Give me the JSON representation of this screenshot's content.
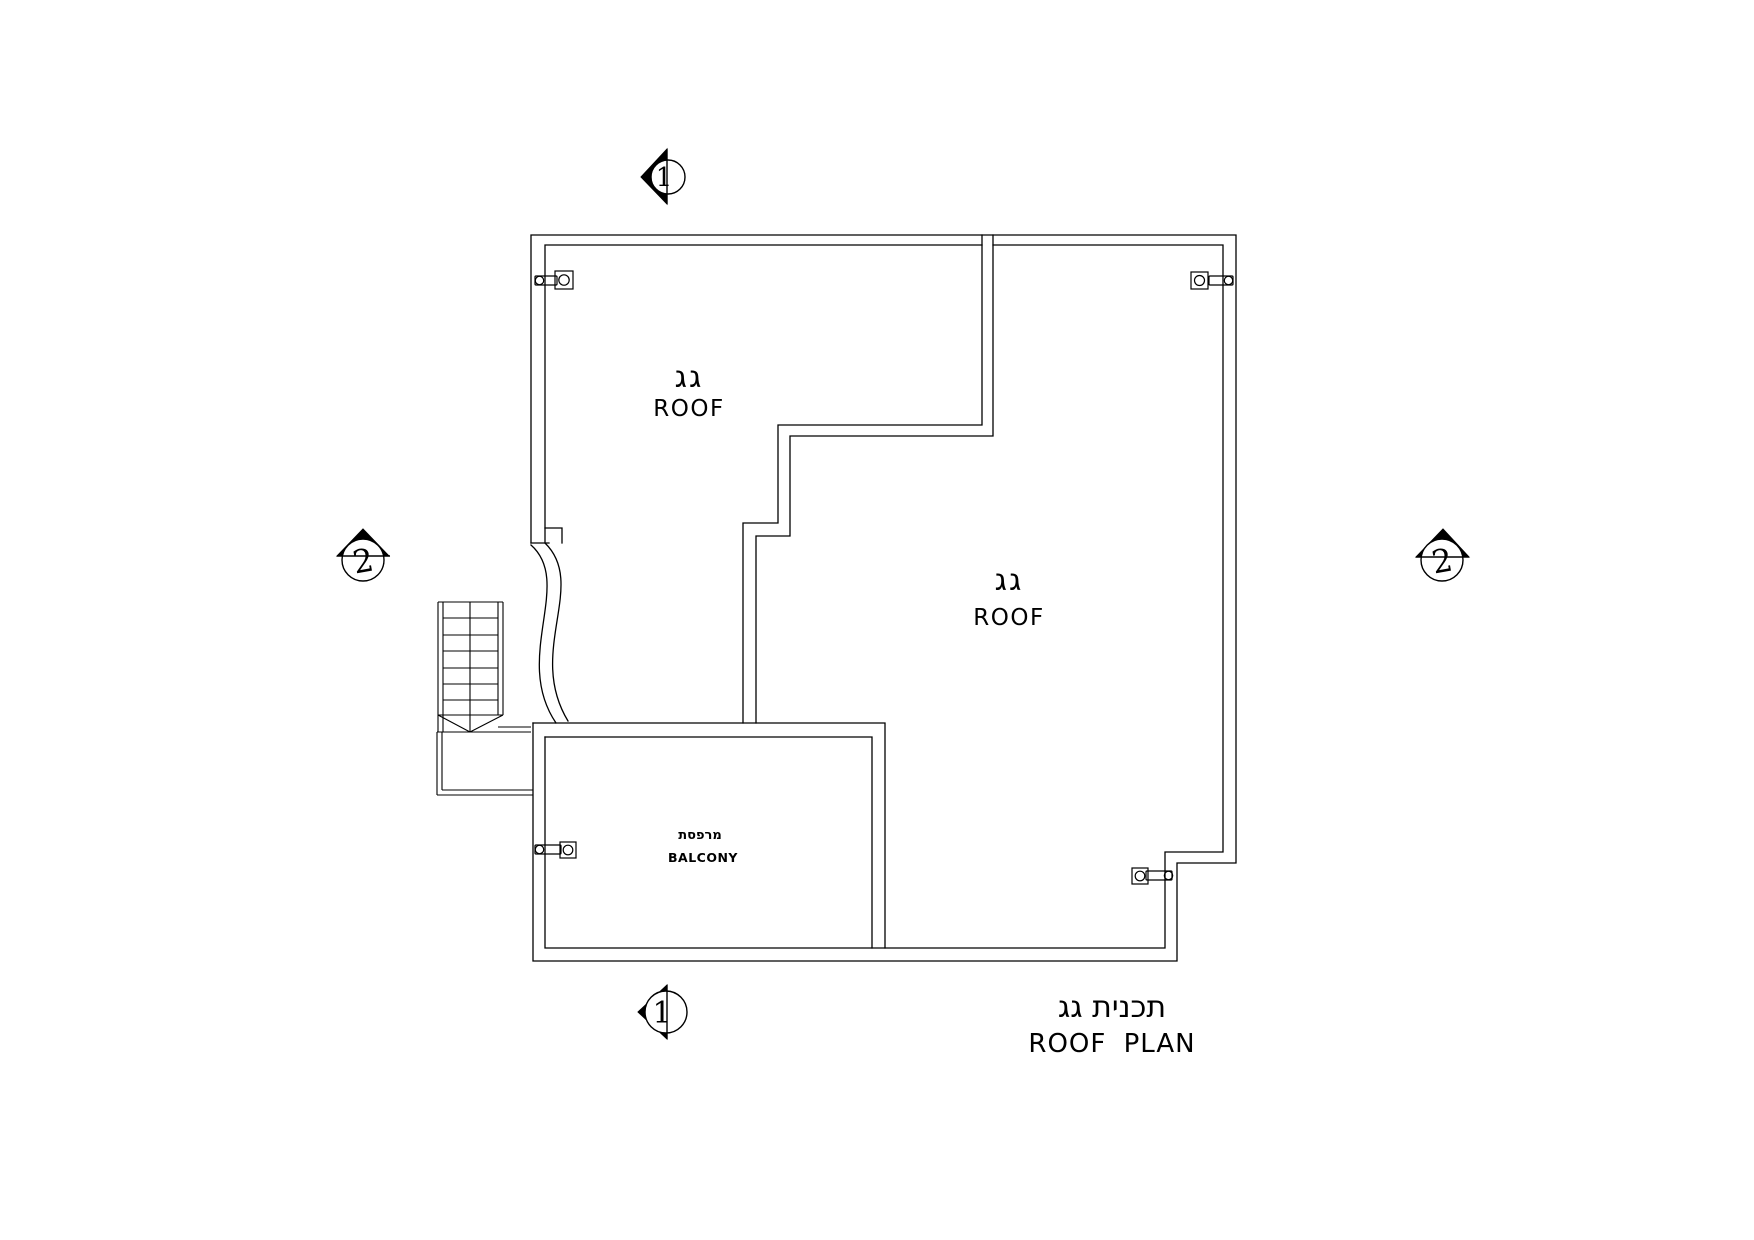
{
  "drawing": {
    "kind": "architectural roof plan",
    "background_color": "#ffffff",
    "line_color": "#000000"
  },
  "rooms": {
    "roof_upper_left": {
      "label_he": "גג",
      "label_en": "ROOF"
    },
    "roof_main": {
      "label_he": "גג",
      "label_en": "ROOF"
    },
    "balcony": {
      "label_he": "מרפסת",
      "label_en": "BALCONY"
    }
  },
  "title": {
    "label_he": "תכנית גג",
    "label_en": "ROOF PLAN"
  },
  "section_markers": {
    "top": {
      "number": "1"
    },
    "bottom": {
      "number": "1"
    },
    "left": {
      "number": "2"
    },
    "right": {
      "number": "2"
    }
  }
}
